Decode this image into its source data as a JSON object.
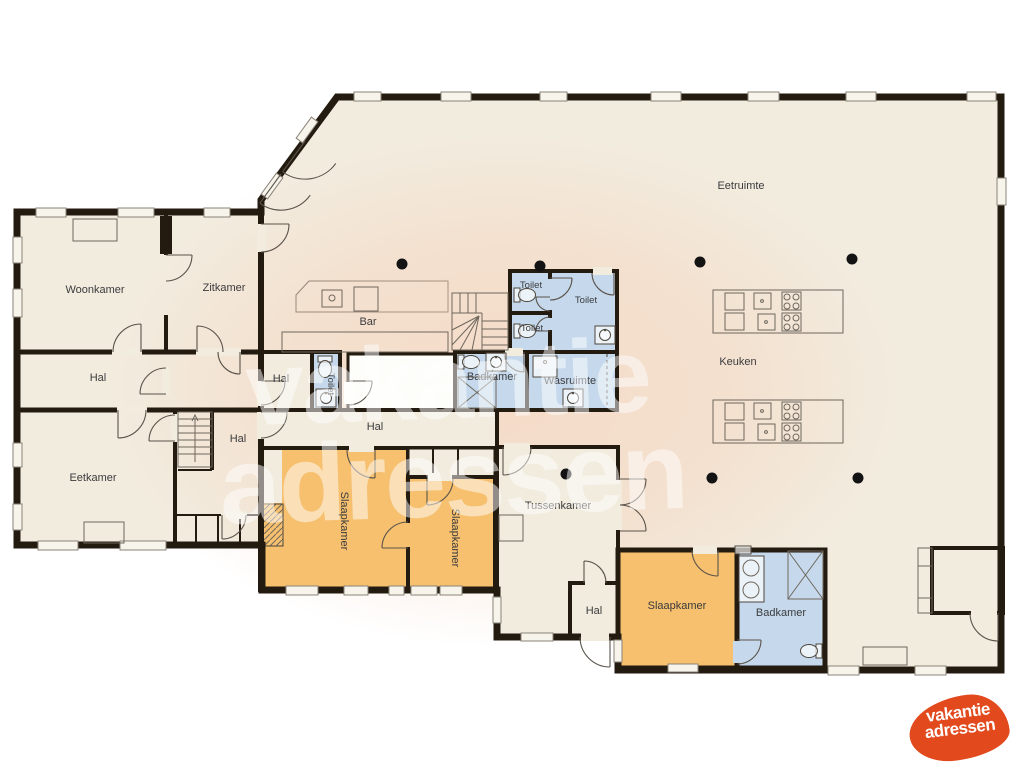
{
  "rooms": {
    "woonkamer": "Woonkamer",
    "zitkamer": "Zitkamer",
    "eetruimte": "Eetruimte",
    "bar": "Bar",
    "keuken": "Keuken",
    "toilet": "Toilet",
    "badkamer": "Badkamer",
    "wasruimte": "Wasruimte",
    "hal": "Hal",
    "eetkamer": "Eetkamer",
    "slaapkamer": "Slaapkamer",
    "tussenkamer": "Tussenkamer"
  },
  "watermark": {
    "line1": "vakantie",
    "line2": "adressen"
  },
  "logo": {
    "line1": "vakantie",
    "line2": "adressen"
  },
  "colors": {
    "wall": "#241b10",
    "floor": "#f2ecdf",
    "wet_room_blue": "#c6d9ec",
    "bedroom_orange": "#f6c06e",
    "blob_tint": "#f6cdb4",
    "watermark": "#ffffff",
    "logo_background": "#e2491c",
    "logo_text": "#ffffff",
    "label_text": "#3b3b3d",
    "pillar": "#131313"
  }
}
